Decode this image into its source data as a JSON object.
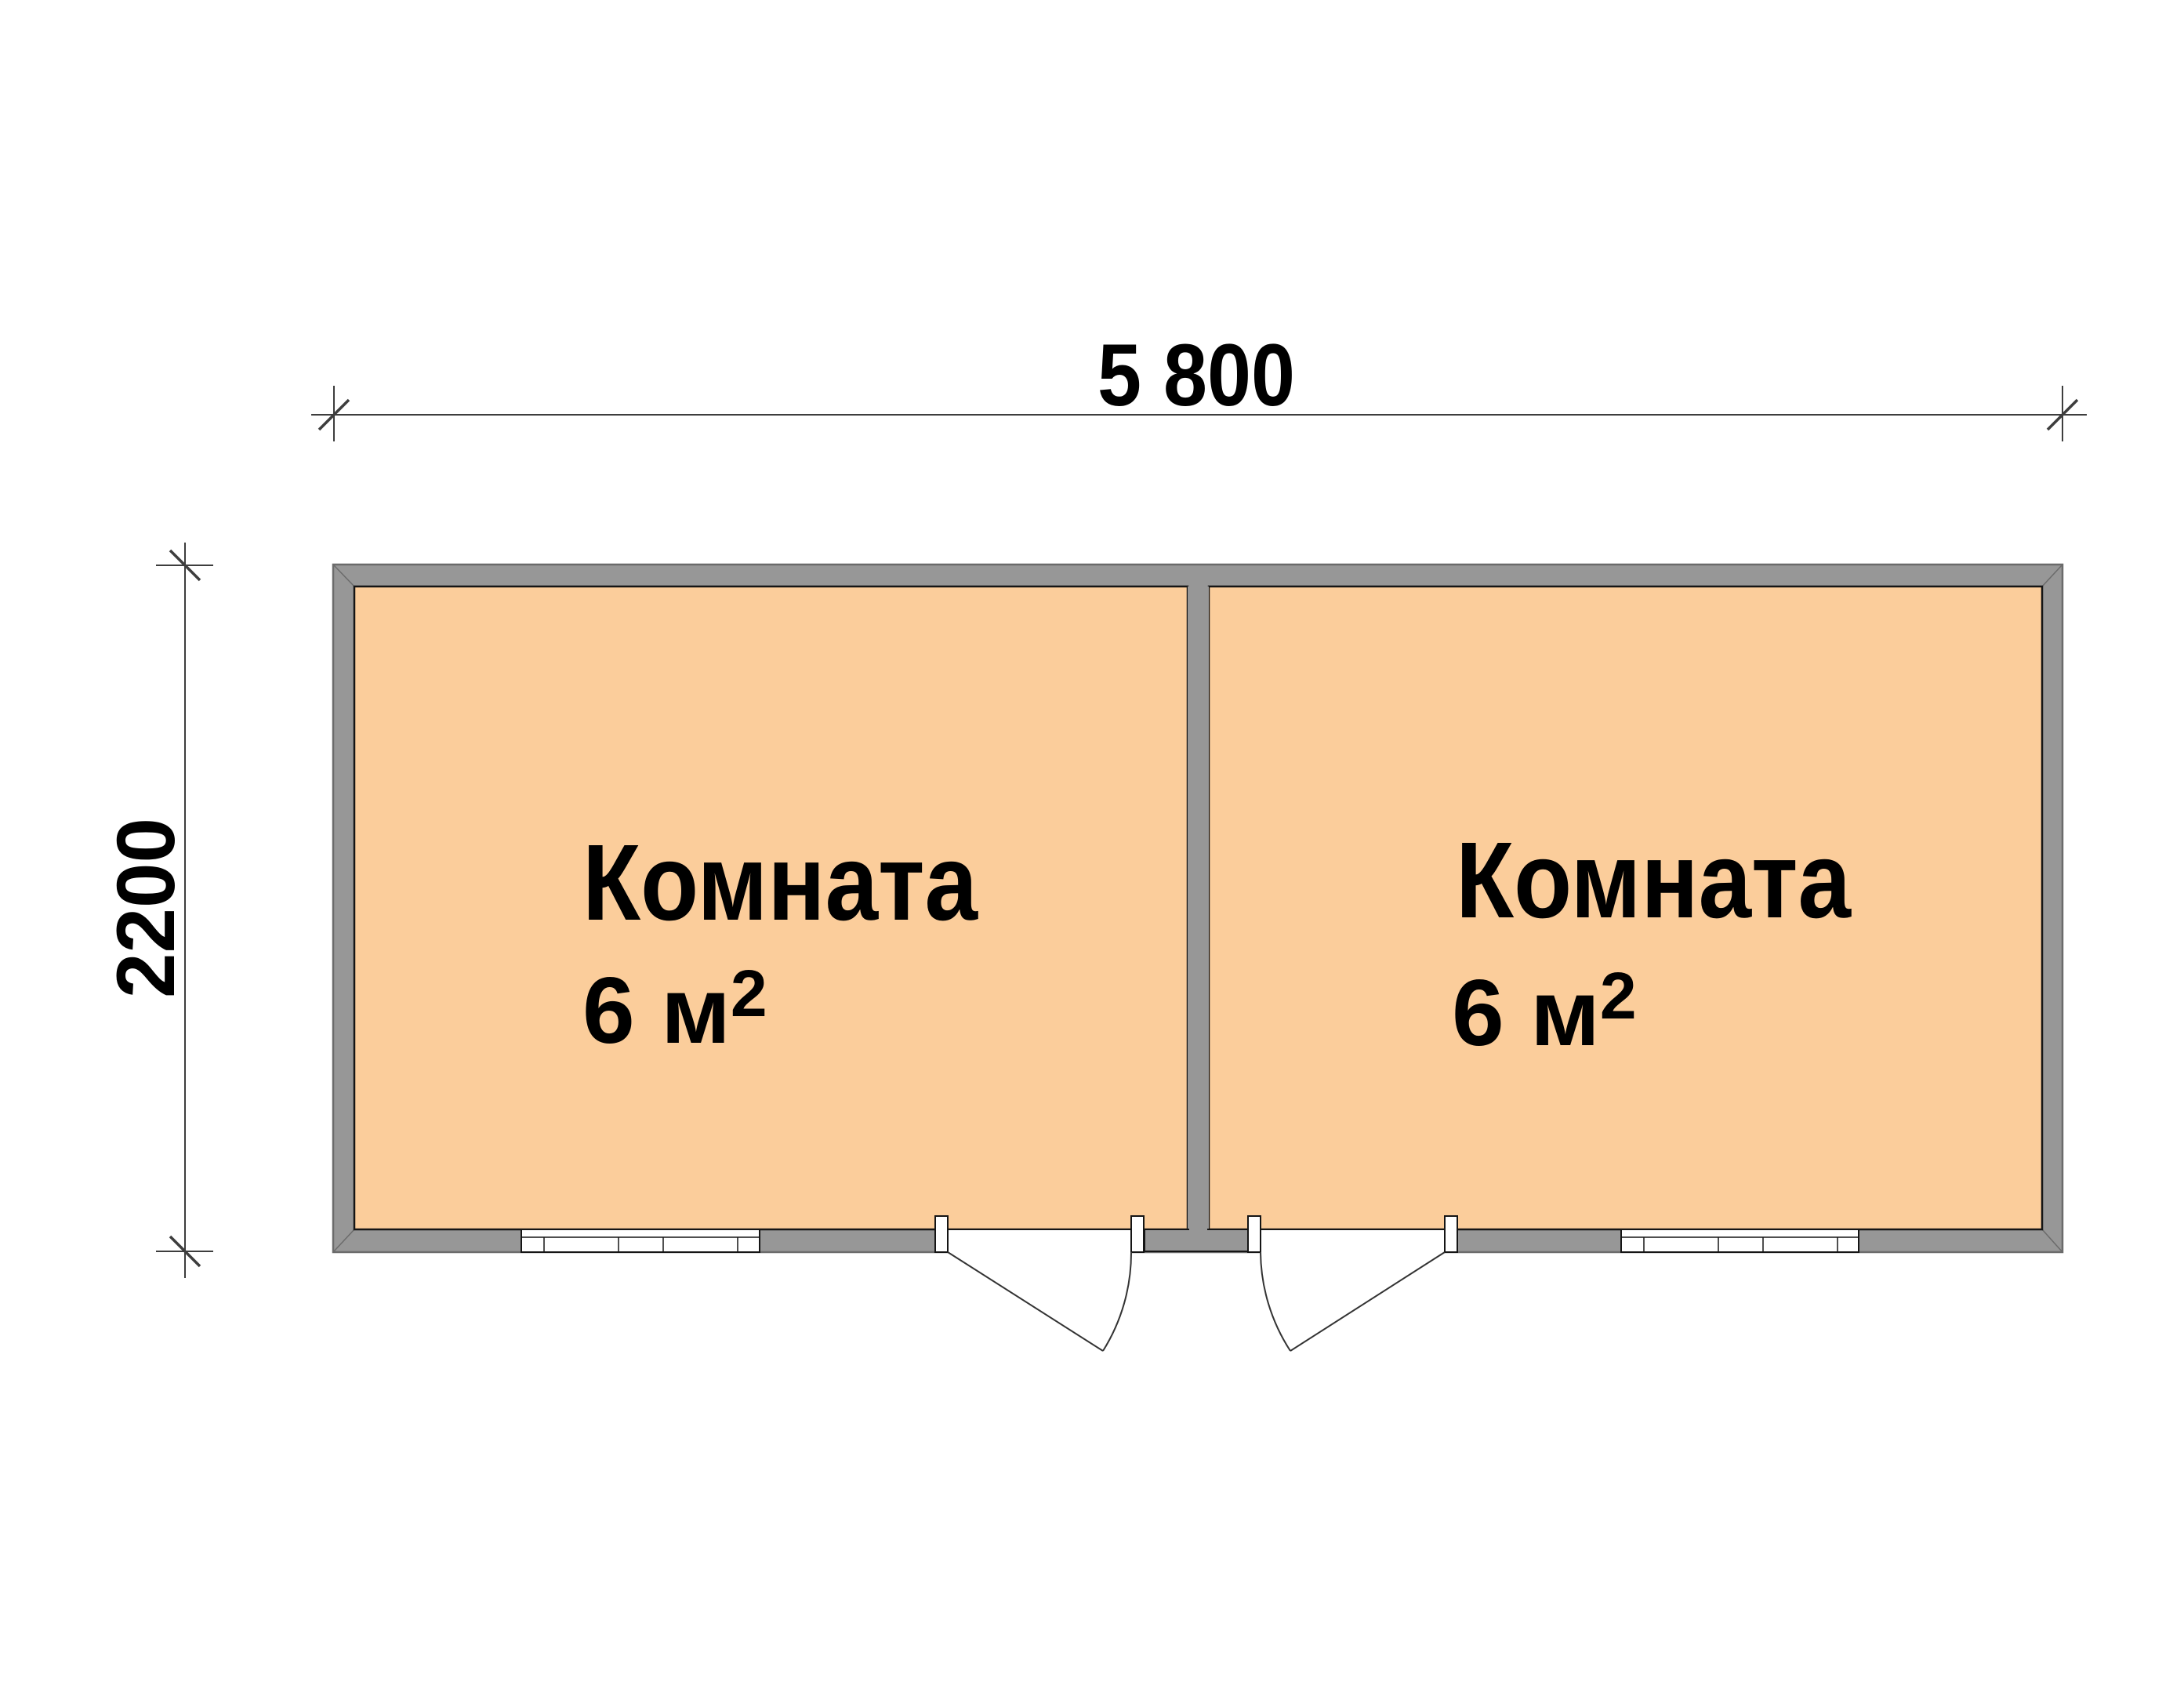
{
  "plan": {
    "dimensions": {
      "width_label": "5 800",
      "height_label": "2200"
    },
    "rooms": [
      {
        "name": "Комната",
        "area_value": "6 м",
        "area_sup": "2"
      },
      {
        "name": "Комната",
        "area_value": "6 м",
        "area_sup": "2"
      }
    ]
  },
  "colors": {
    "background": "#ffffff",
    "room_fill": "#fbcd9b",
    "wall_fill": "#979797",
    "wall_edge": "#6b6b6b",
    "outline": "#151515",
    "door_line": "#333333",
    "dim_line": "#3d3d3d",
    "opening_fill": "#ffffff",
    "text_color": "#000000"
  }
}
